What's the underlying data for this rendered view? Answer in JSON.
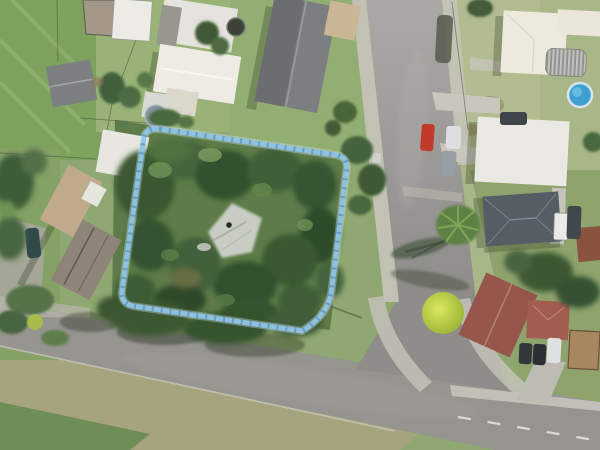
{
  "map": {
    "view": "aerial-imagery",
    "description": "Aerial photo of suburban block with highlighted property parcel, T-intersection of two streets, houses, trees and parked cars",
    "parcel_overlay": {
      "path": "M 160 129 L 336 155 Q 348 157 346.5 169 L 331.5 291 Q 328.5 315 302 331 L 136 306.5 Q 120.5 305 122 291 L 143.5 140 Q 145 127.5 158 129 Z",
      "halo_color": "#d4e9f6",
      "line_color": "#90c4e4",
      "hatch_color": "#5e96bd"
    },
    "palette": {
      "asphalt": "#9a9894",
      "concrete": "#c6c4ba",
      "lawn": "#96b176",
      "dry_grass": "#aab88a",
      "forest": "#3e5c36",
      "verge": "#a5a37d",
      "bright_tree": "#c3d44c",
      "pool_blue": "#3e9fd0",
      "red_car": "#c0392b"
    }
  }
}
